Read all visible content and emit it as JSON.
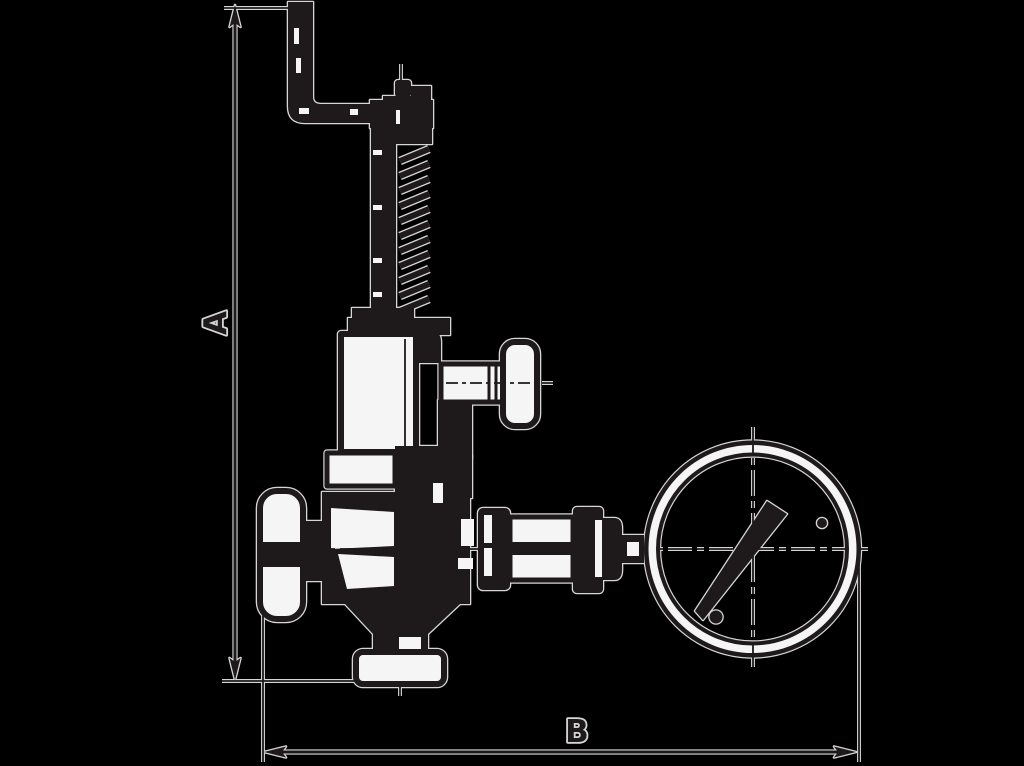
{
  "diagram": {
    "type": "technical-line-drawing",
    "subject": "safety relief valve with test lever, handwheels and pressure gauge, dimensioned",
    "background_color": "#000000",
    "ink_color": "#1e1a1b",
    "halo_color": "#d6d6d6",
    "paper_color": "#f5f5f5",
    "labels": {
      "dimension_a": "A",
      "dimension_b": "B"
    }
  }
}
